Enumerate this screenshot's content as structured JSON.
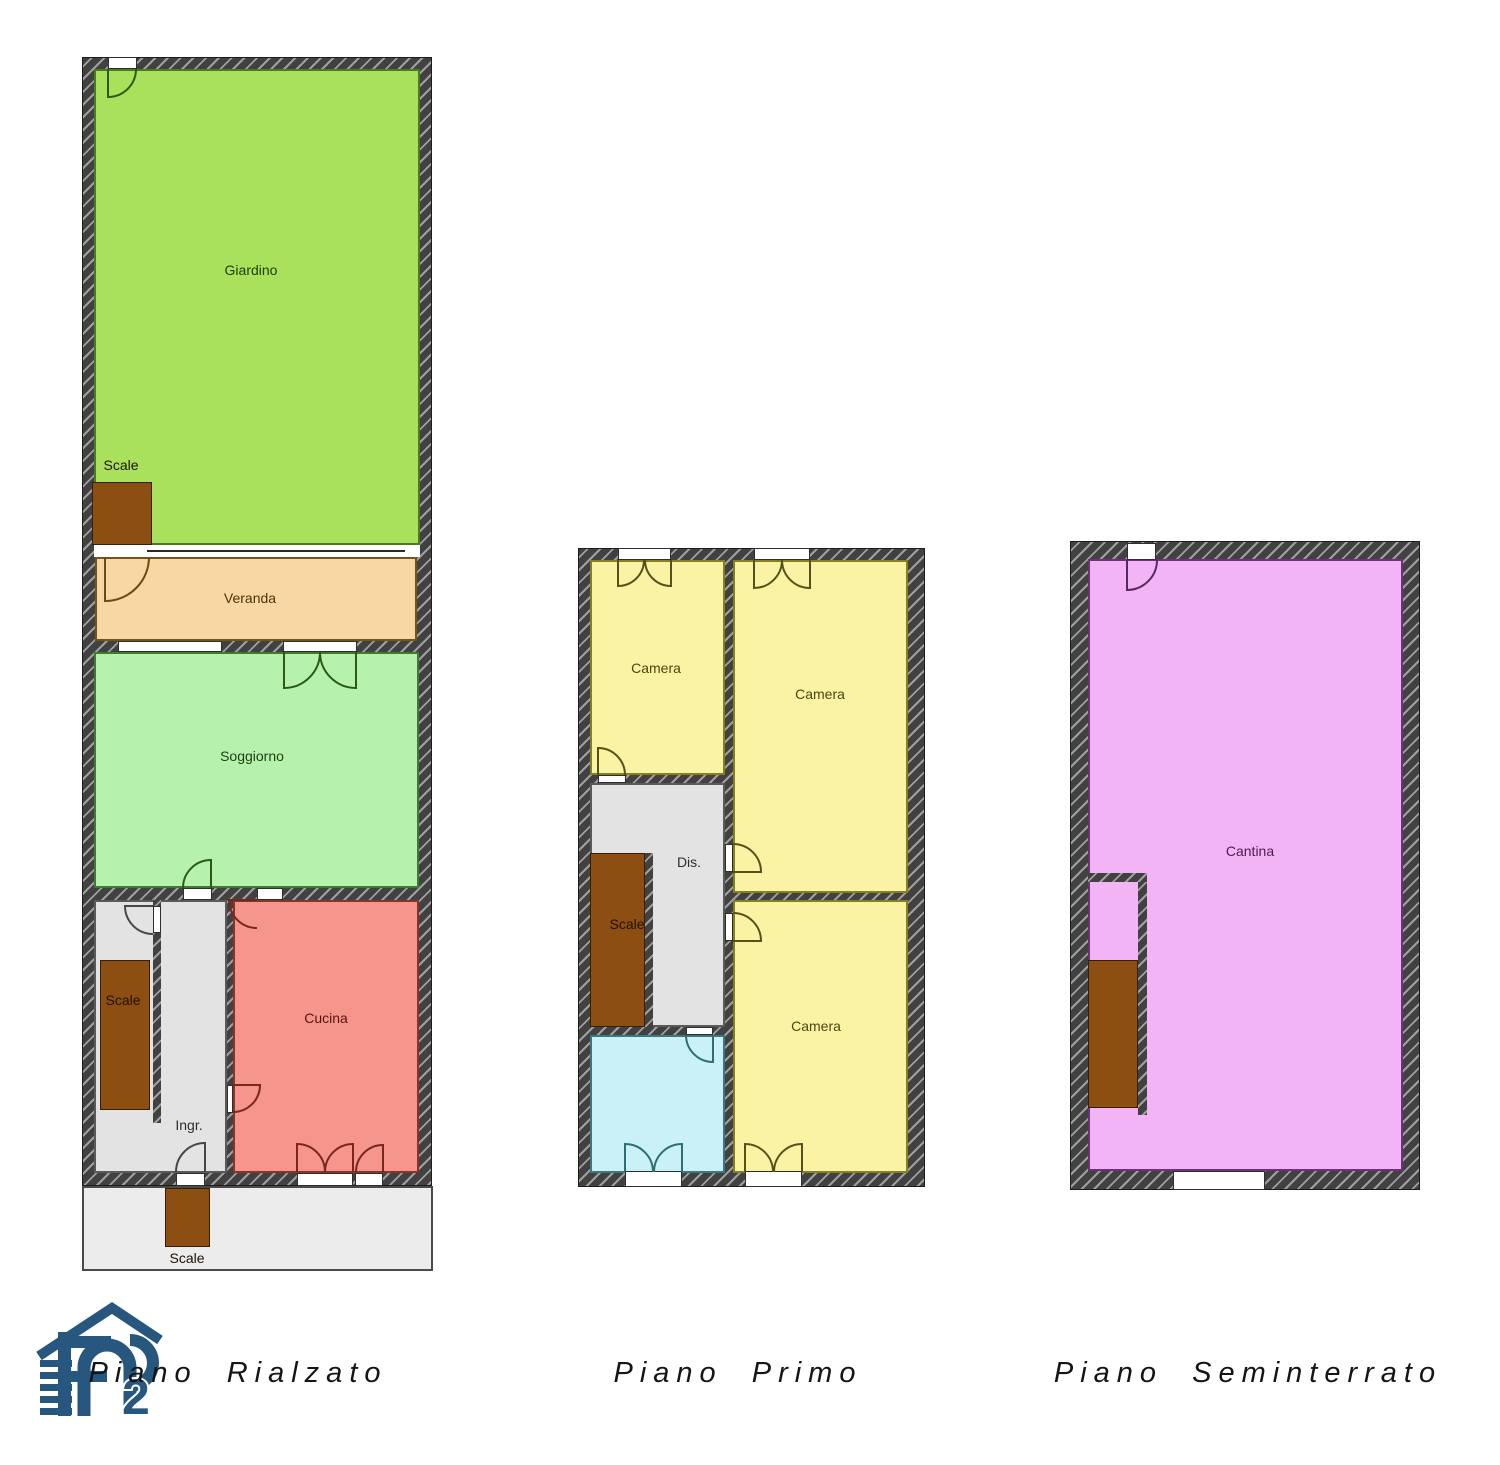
{
  "floors": [
    {
      "title": "Piano Rialzato",
      "rooms": [
        {
          "label": "Giardino"
        },
        {
          "label": "Scale"
        },
        {
          "label": "Veranda"
        },
        {
          "label": "Soggiorno"
        },
        {
          "label": "Scale"
        },
        {
          "label": "Ingr."
        },
        {
          "label": "Cucina"
        },
        {
          "label": "Scale"
        }
      ]
    },
    {
      "title": "Piano Primo",
      "rooms": [
        {
          "label": "Camera"
        },
        {
          "label": "Camera"
        },
        {
          "label": "Dis."
        },
        {
          "label": "Scale"
        },
        {
          "label": "Camera"
        }
      ]
    },
    {
      "title": "Piano Seminterrato",
      "rooms": [
        {
          "label": "Cantina"
        }
      ]
    }
  ],
  "logo": {
    "monogram": "FP",
    "subscript": "2",
    "color": "#27567f"
  },
  "colors": {
    "wall": "#3e3e3e",
    "wall_hatch": "#9f9f9f",
    "garden": "#a9e15c",
    "veranda": "#f8d7a2",
    "living": "#b7f1ae",
    "kitchen": "#f6958c",
    "bedroom": "#faf3a3",
    "bathroom": "#cbf1f8",
    "cellar": "#f2b4f4",
    "stairs": "#8d4e12",
    "hallway": "#e3e3e3",
    "porch": "#ececec"
  }
}
